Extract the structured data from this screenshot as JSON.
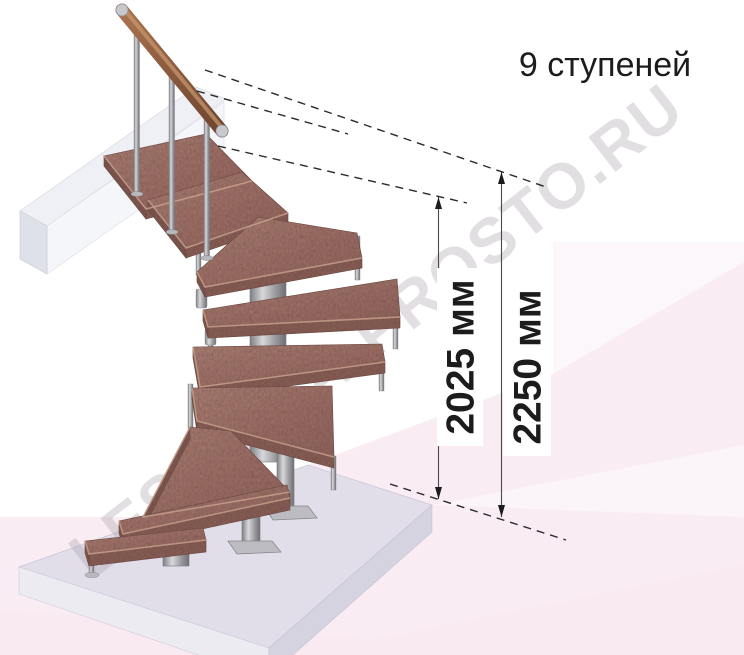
{
  "title": {
    "text": "9 ступеней"
  },
  "dimensions": {
    "inner": {
      "label": "2025 мм"
    },
    "outer": {
      "label": "2250 мм"
    }
  },
  "watermark": {
    "text": "LESTNICA-PROSTO.RU"
  },
  "colors": {
    "wood": "#9e7168",
    "wood_edge": "#7d5750",
    "metal": "#a9a9ad",
    "floor_pink": "#f9edf3",
    "slab_top": "#e1deea",
    "annotation_text": "#1c1c1c"
  }
}
